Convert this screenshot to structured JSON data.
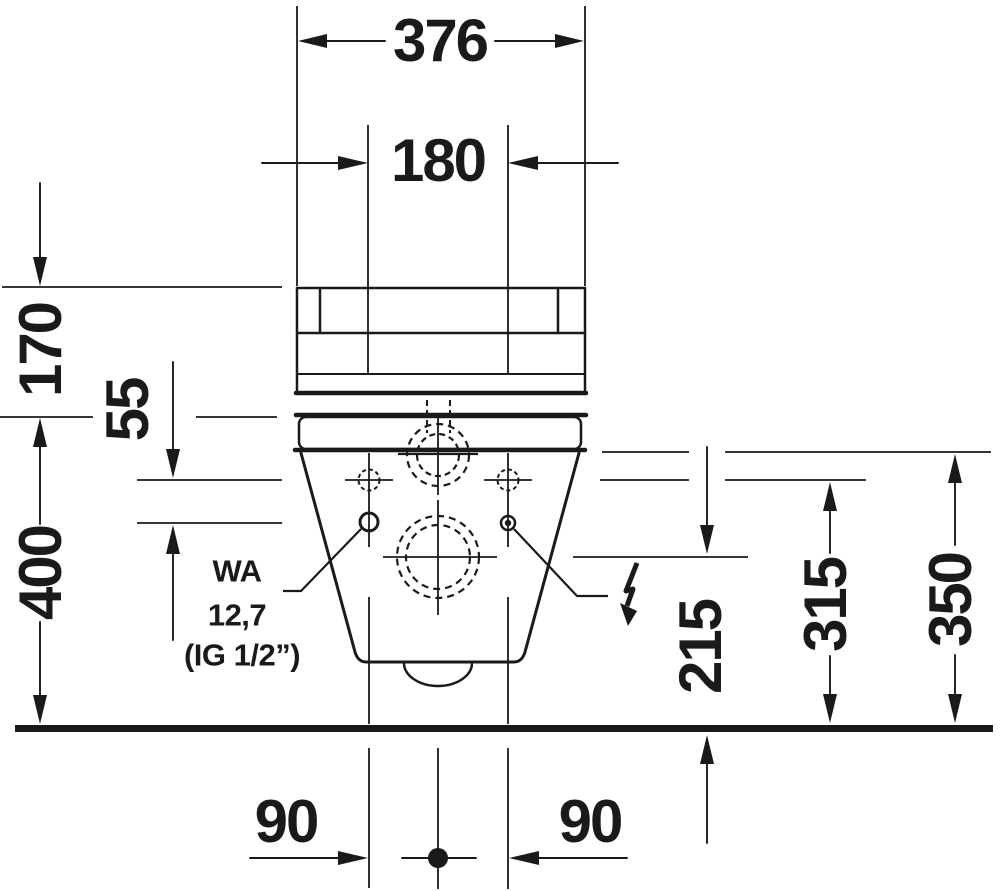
{
  "drawing": {
    "background": "#ffffff",
    "line_color": "#1a1a1a"
  },
  "dimensions": {
    "overall_width": "376",
    "hole_spacing": "180",
    "tank_height": "170",
    "supply_offset": "55",
    "rim_height": "400",
    "outlet_height": "215",
    "hole_height": "315",
    "supply_height": "350",
    "hole_offset_left": "90",
    "hole_offset_right": "90"
  },
  "annotations": {
    "water_line1": "WA",
    "water_line2": "12,7",
    "water_line3": "(IG 1/2”)"
  },
  "icons": {
    "electrical": "lightning-bolt"
  }
}
